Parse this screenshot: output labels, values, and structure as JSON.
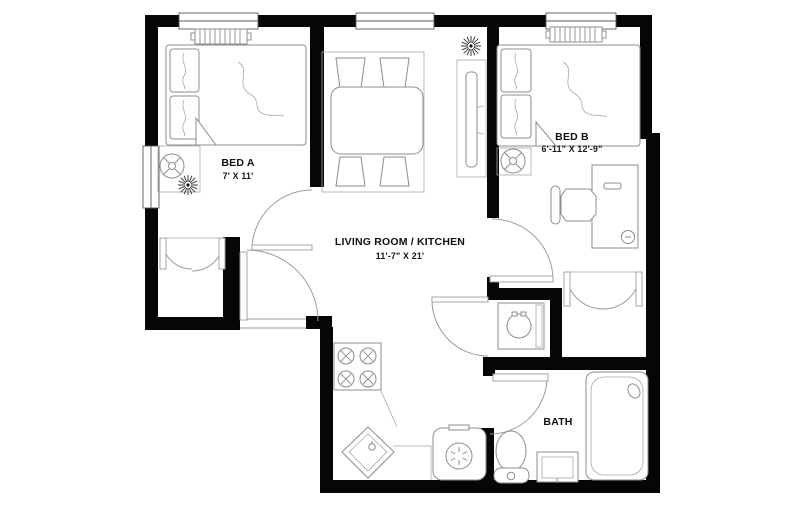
{
  "plan": {
    "type": "apartment-floor-plan",
    "rooms": {
      "bed_a": {
        "name": "BED A",
        "dims": "7' X 11'"
      },
      "bed_b": {
        "name": "BED B",
        "dims": "6'-11\" X 12'-9\""
      },
      "living": {
        "name": "LIVING ROOM / KITCHEN",
        "dims": "11'-7\" X 21'"
      },
      "bath": {
        "name": "BATH"
      }
    },
    "colors": {
      "wall": "#060606",
      "background": "#ffffff",
      "furniture_line": "#8d8d8d",
      "text": "#101010"
    },
    "icons": {
      "bed": "rect-with-pillows",
      "radiator": "finned-rect",
      "plant": "starburst",
      "lamp": "circle-with-spokes",
      "dining-table": "rounded-rect-4-chairs",
      "tv-console": "thin-rect-semicircle",
      "stove": "rect-4-burners",
      "kitchen-sink": "corner-diamond",
      "washer": "square-with-circle",
      "dryer": "rounded-square-fan",
      "toilet": "oval-with-tank",
      "vanity-sink": "nested-rect",
      "bathtub": "rounded-rect-drain",
      "desk-chair": "octagon-with-back",
      "door": "quarter-arc",
      "double-closet-door": "twin-quarter-arcs",
      "window": "double-line-gap"
    }
  }
}
